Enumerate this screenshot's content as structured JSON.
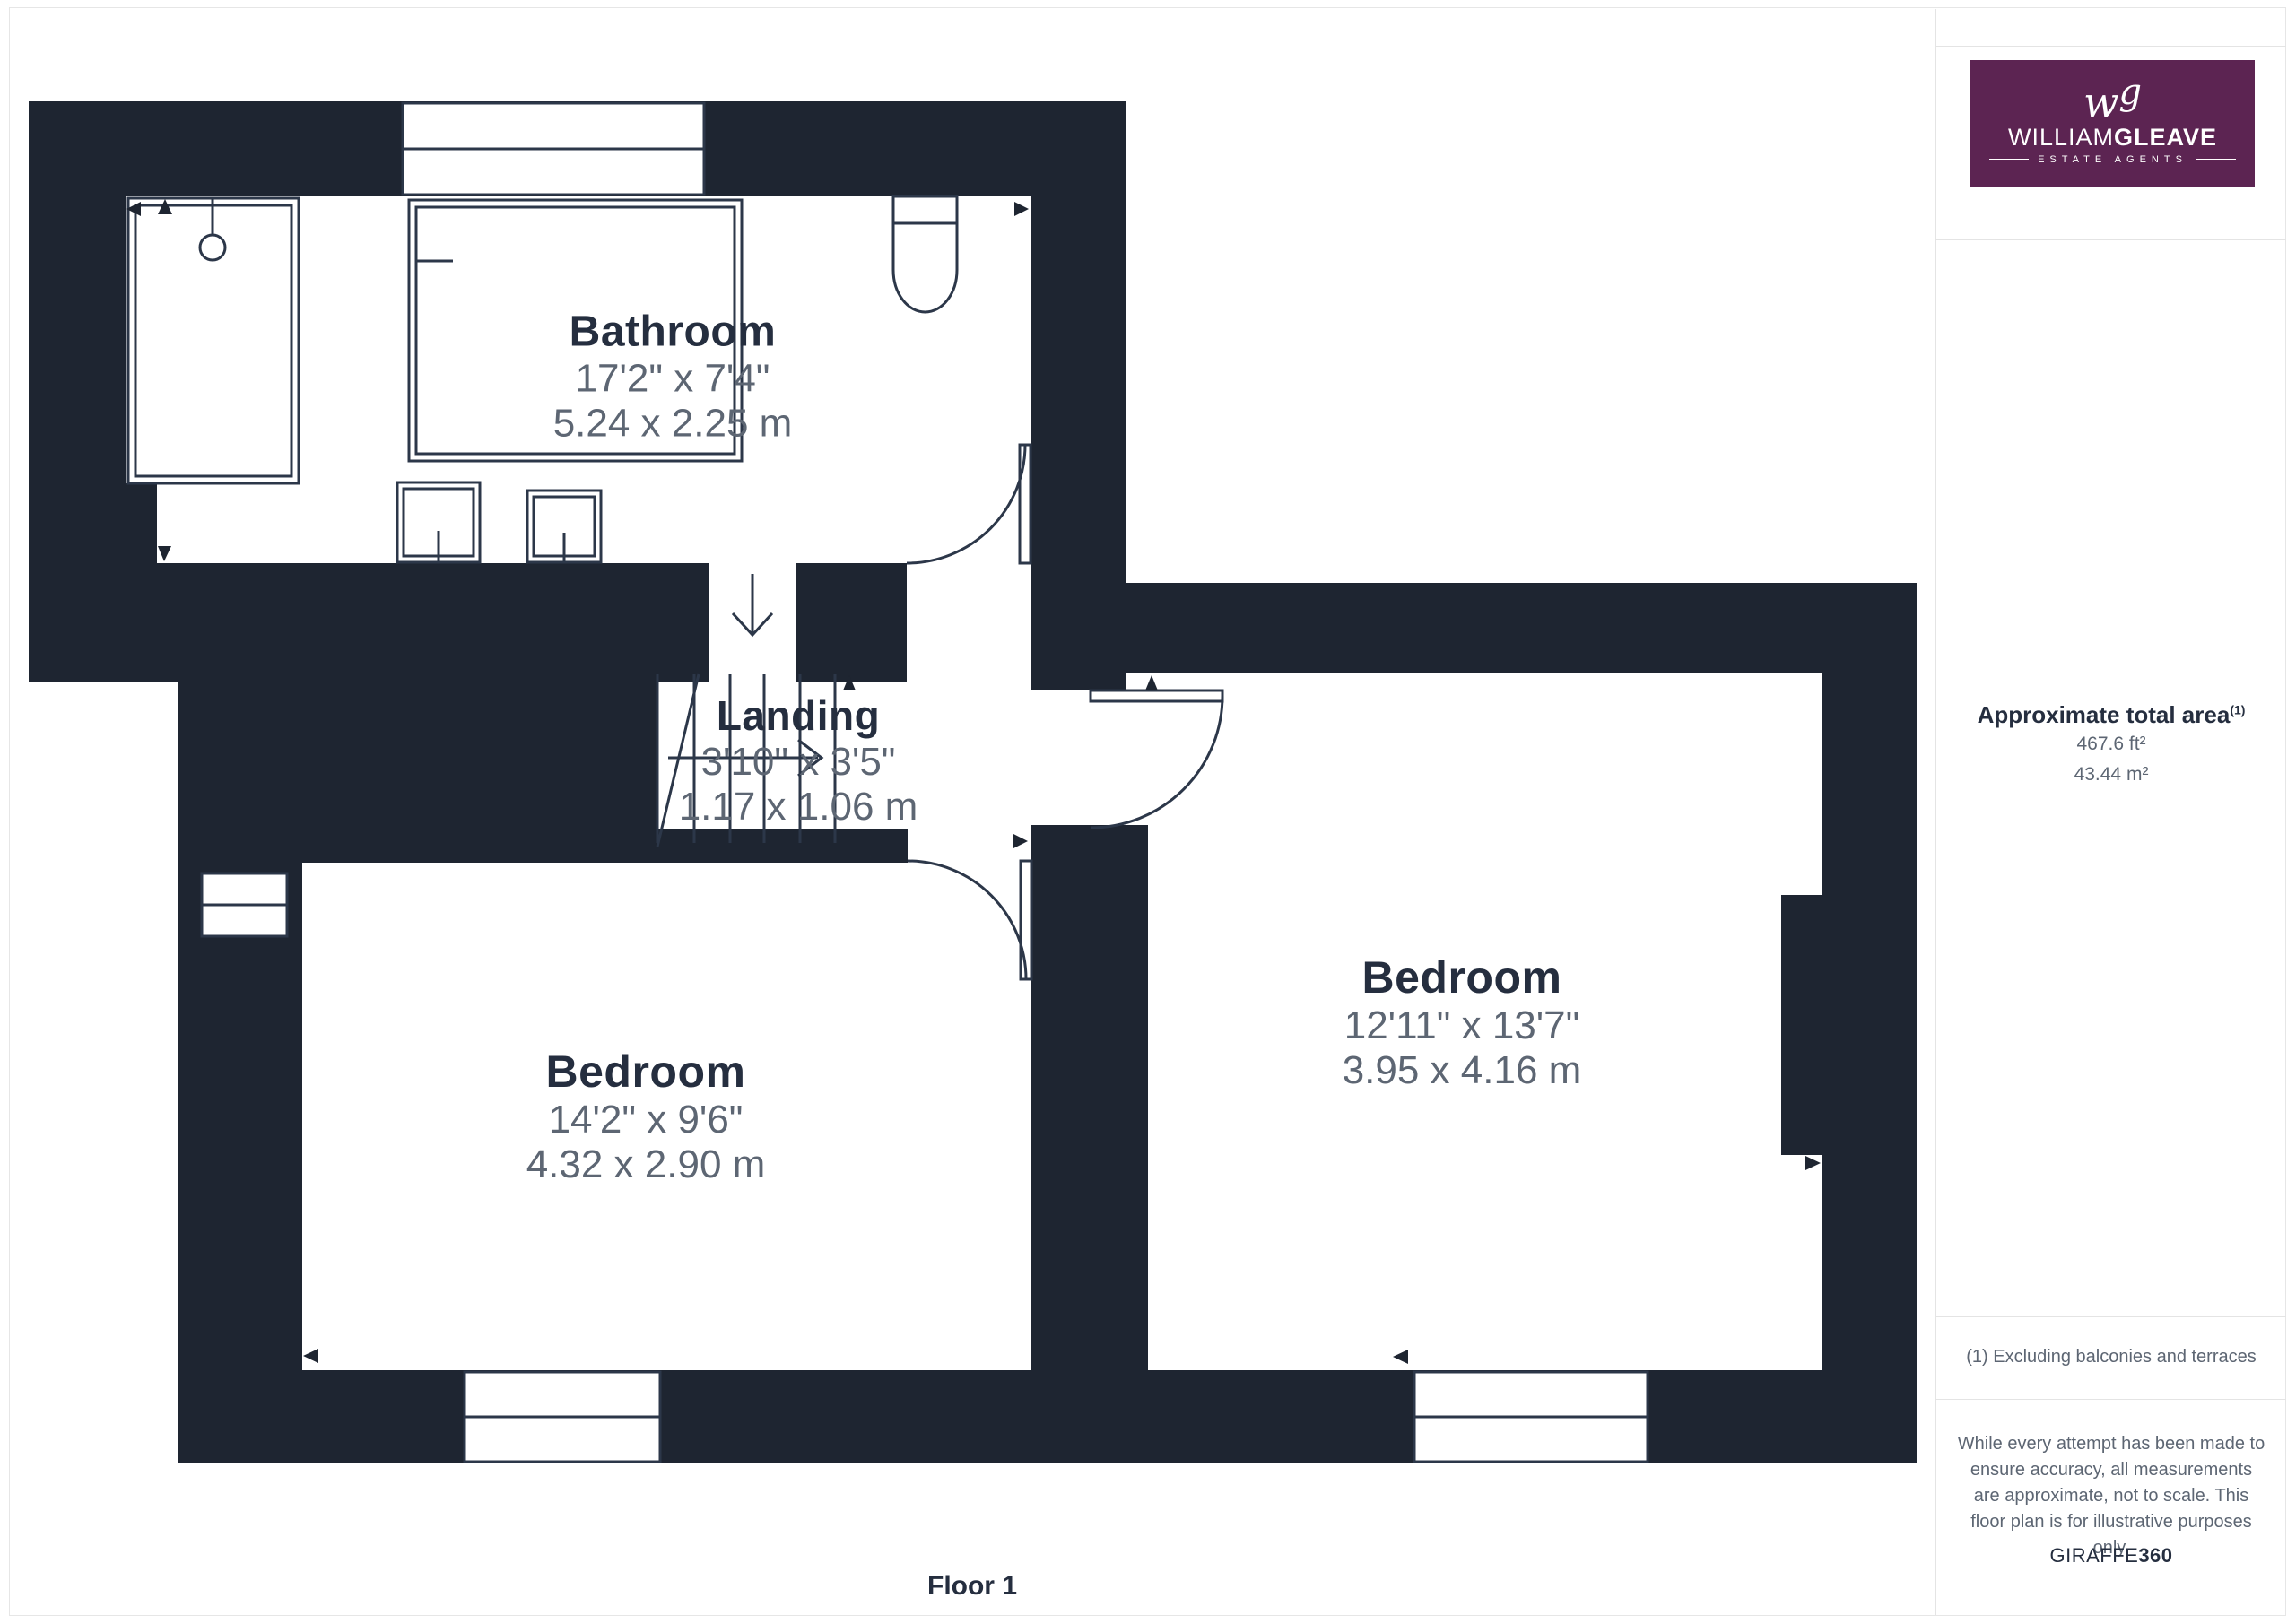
{
  "plan": {
    "floor_label": "Floor 1",
    "rooms": [
      {
        "id": "bathroom",
        "name": "Bathroom",
        "dims_imperial": "17'2\" x 7'4\"",
        "dims_metric": "5.24 x 2.25 m"
      },
      {
        "id": "landing",
        "name": "Landing",
        "dims_imperial": "3'10\" x 3'5\"",
        "dims_metric": "1.17 x 1.06 m"
      },
      {
        "id": "bedroom-left",
        "name": "Bedroom",
        "dims_imperial": "14'2\" x 9'6\"",
        "dims_metric": "4.32 x 2.90 m"
      },
      {
        "id": "bedroom-right",
        "name": "Bedroom",
        "dims_imperial": "12'11\" x 13'7\"",
        "dims_metric": "3.95 x 4.16 m"
      }
    ]
  },
  "sidebar": {
    "logo": {
      "monogram_w": "w",
      "monogram_g": "g",
      "brand_regular": "WILLIAM",
      "brand_bold": "GLEAVE",
      "tagline": "ESTATE AGENTS"
    },
    "area": {
      "title": "Approximate total area",
      "footnote_marker": "(1)",
      "imperial": "467.6 ft²",
      "metric": "43.44 m²"
    },
    "footnote": "(1) Excluding balconies and terraces",
    "disclaimer": "While every attempt has been made to ensure accuracy, all measurements are approximate, not to scale. This floor plan is for illustrative purposes only.",
    "credit_regular": "GIRAFFE",
    "credit_bold": "360"
  },
  "colors": {
    "wall": "#1e2531",
    "line": "#2c3749",
    "text": "#252e3f",
    "dim_text": "#5d6673",
    "brand_purple": "#5c2452",
    "divider": "#e4e4e4"
  }
}
